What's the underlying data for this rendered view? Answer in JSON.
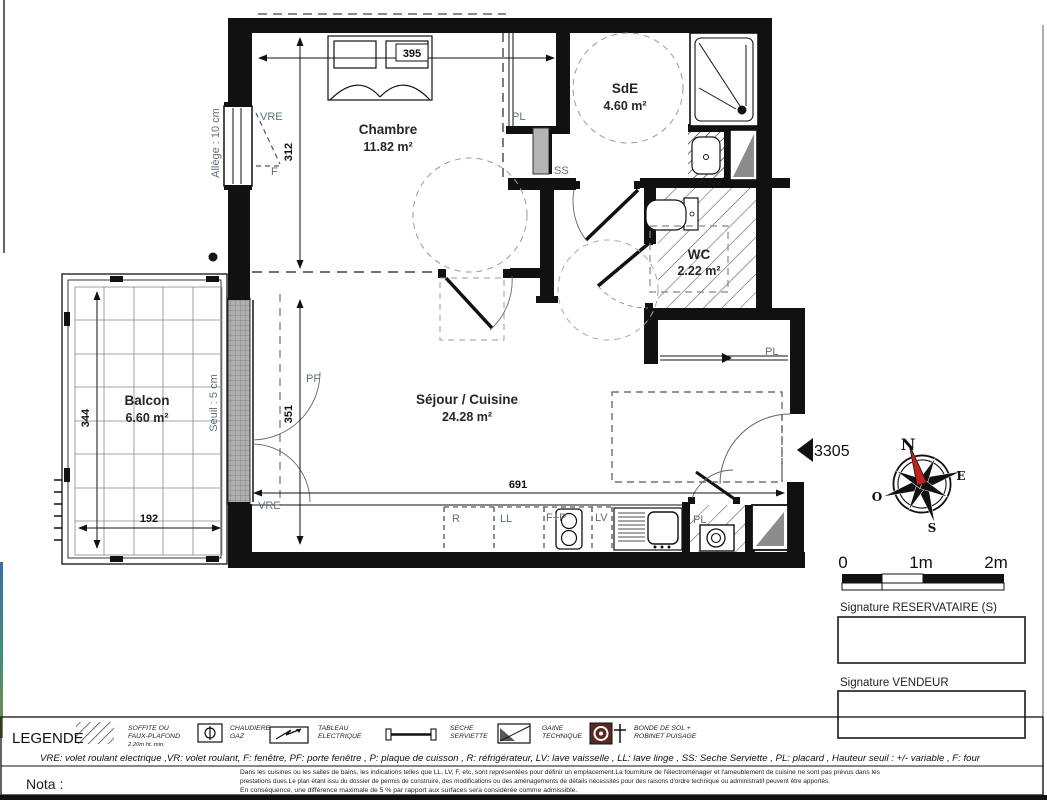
{
  "plan": {
    "rooms": [
      {
        "name": "Chambre",
        "area": "11.82 m²"
      },
      {
        "name": "SdE",
        "area": "4.60 m²"
      },
      {
        "name": "WC",
        "area": "2.22 m²"
      },
      {
        "name": "Balcon",
        "area": "6.60 m²"
      },
      {
        "name": "Séjour / Cuisine",
        "area": "24.28 m²"
      }
    ],
    "dimensions": {
      "chambre_width": "395",
      "chambre_depth": "312",
      "balcon_depth": "344",
      "balcon_width": "192",
      "bay_height": "351",
      "sejour_width": "691"
    },
    "annotations": {
      "allege": "Allège : 10 cm",
      "seuil": "Seuil : 5 cm",
      "vre_top": "VRE",
      "f_window": "F",
      "pl_top": "PL",
      "ss": "SS",
      "pf": "PF",
      "vre_balcony": "VRE",
      "pl_hall": "PL",
      "pl_kitchen": "PL",
      "fridge": "R",
      "washer": "LL",
      "oven_hob": "F+P",
      "dishwasher": "LV",
      "unit_number": "3305"
    }
  },
  "compass": {
    "n": "N",
    "e": "E",
    "s": "S",
    "o": "O"
  },
  "scale_bar": {
    "t0": "0",
    "t1": "1m",
    "t2": "2m"
  },
  "signatures": {
    "reservataire": "Signature RESERVATAIRE (S)",
    "vendeur": "Signature VENDEUR"
  },
  "legend": {
    "title": "LEGENDE",
    "items": [
      {
        "icon": "soffite-hatch-icon",
        "l1": "SOFFITE OU",
        "l2": "FAUX-PLAFOND",
        "sub": "2.20m ht. min."
      },
      {
        "icon": "chaudiere-gaz-icon",
        "l1": "CHAUDIERE",
        "l2": "GAZ",
        "sub": ""
      },
      {
        "icon": "tableau-electrique-icon",
        "l1": "TABLEAU",
        "l2": "ELECTRIQUE",
        "sub": ""
      },
      {
        "icon": "seche-serviette-icon",
        "l1": "SECHE",
        "l2": "SERVIETTE",
        "sub": ""
      },
      {
        "icon": "gaine-technique-icon",
        "l1": "GAINE",
        "l2": "TECHNIQUE",
        "sub": ""
      },
      {
        "icon": "bonde-de-sol-icon",
        "l1": "BONDE DE SOL +",
        "l2": "ROBINET PUISAGE",
        "sub": ""
      }
    ],
    "abbreviations": "VRE: volet roulant electrique ,VR: volet roulant, F: fenêtre, PF: porte fenêtre , P: plaque de cuisson , R: réfrigérateur, LV: lave vaisselle , LL: lave linge , SS: Seche Serviette , PL: placard , Hauteur seuil : +/- variable , F: four"
  },
  "nota": {
    "label": "Nota :",
    "lines": [
      "Dans les cuisines ou les salles de bains, les indications telles que LL, LV, F, etc, sont représentées pour définir un emplacement.La fourniture de l'électroménager et l'ameublement de cuisine ne sont pas prévus dans les",
      "prestations dues.Le plan étant issu du dossier de permis de construire, des modifications ou des aménagements de détails nécessités pour des raisons d'ordre technique ou administratif peuvent être apportés.",
      "En conséquence, une différence maximale de 5 % par rapport aux surfaces sera considérée comme admissible."
    ]
  },
  "colors": {
    "wall": "#111111",
    "needle_red": "#c5201c",
    "bonde_brown": "#5a2a22",
    "gaine_gray": "#8c8c8c"
  }
}
